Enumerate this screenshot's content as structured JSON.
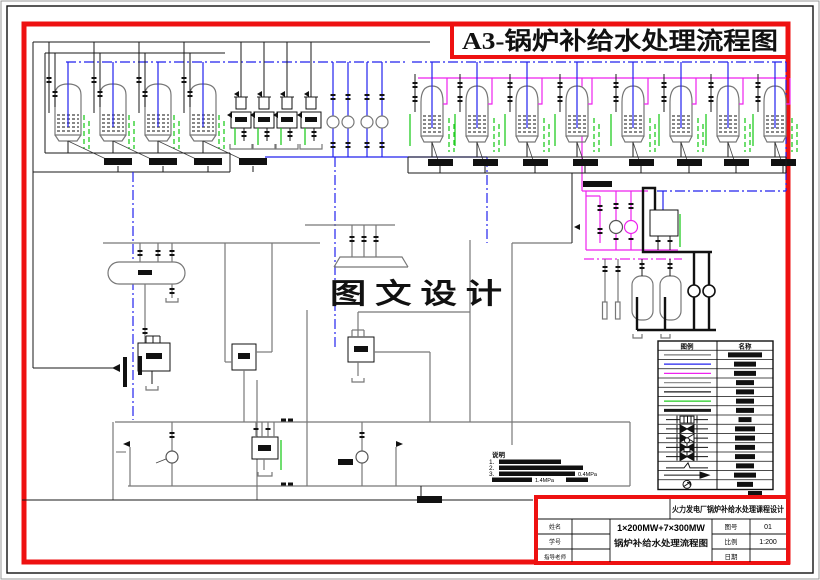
{
  "banner": {
    "title": "A3-锅炉补给水处理流程图",
    "color": "#ee1111"
  },
  "watermark": {
    "text": "图 文 设 计"
  },
  "colors": {
    "red": "#ee1111",
    "blue": "#2222ee",
    "magenta": "#ee22ee",
    "green": "#22cc22",
    "pipe_gray": "#787878",
    "black": "#1a1a1a"
  },
  "legend": {
    "header": {
      "symbol_col": "图例",
      "name_col": "名称"
    },
    "rows": [
      {
        "kind": "line",
        "color": "#787878",
        "thick": 1.2,
        "bar_w": 34
      },
      {
        "kind": "line",
        "color": "#2222ee",
        "thick": 1.2,
        "bar_w": 22
      },
      {
        "kind": "line",
        "color": "#ee22ee",
        "thick": 1.2,
        "bar_w": 22
      },
      {
        "kind": "line",
        "color": "#909090",
        "thick": 1.2,
        "bar_w": 18
      },
      {
        "kind": "line",
        "color": "#1a1a1a",
        "thick": 1.2,
        "bar_w": 18
      },
      {
        "kind": "line",
        "color": "#22cc22",
        "thick": 1.3,
        "bar_w": 18
      },
      {
        "kind": "line",
        "color": "#1a1a1a",
        "thick": 3,
        "bar_w": 18
      },
      {
        "kind": "glyph",
        "glyph": "gate-valve",
        "bar_w": 13
      },
      {
        "kind": "glyph",
        "glyph": "valve-bowtie",
        "bar_w": 20
      },
      {
        "kind": "glyph",
        "glyph": "valve-bowtie-check",
        "bar_w": 20
      },
      {
        "kind": "glyph",
        "glyph": "valve-circle-actuator",
        "bar_w": 20
      },
      {
        "kind": "glyph",
        "glyph": "valve-square-actuator",
        "bar_w": 20
      },
      {
        "kind": "glyph",
        "glyph": "hand-lever",
        "bar_w": 18
      },
      {
        "kind": "glyph",
        "glyph": "flow-arrow",
        "bar_w": 22
      },
      {
        "kind": "glyph",
        "glyph": "pump-symbol",
        "bar_w": 16
      }
    ]
  },
  "notes": {
    "header": "说明",
    "items": [
      {
        "no": "1.",
        "suffix": ""
      },
      {
        "no": "2.",
        "suffix": ""
      },
      {
        "no": "3.",
        "suffix": "0.4MPa"
      },
      {
        "no": "",
        "suffix": "1.4MPa"
      }
    ]
  },
  "title_block": {
    "project": "火力发电厂锅炉补给水处理课程设计",
    "drawing_title_line1": "1×200MW+7×300MW",
    "drawing_title_line2": "锅炉补给水处理流程图",
    "left_fields": [
      {
        "label": "姓名",
        "value": ""
      },
      {
        "label": "学号",
        "value": ""
      },
      {
        "label": "指导老师",
        "value": ""
      }
    ],
    "right_fields": [
      {
        "label": "图号",
        "value": "01"
      },
      {
        "label": "比例",
        "value": "1:200"
      },
      {
        "label": "日期",
        "value": ""
      }
    ]
  }
}
